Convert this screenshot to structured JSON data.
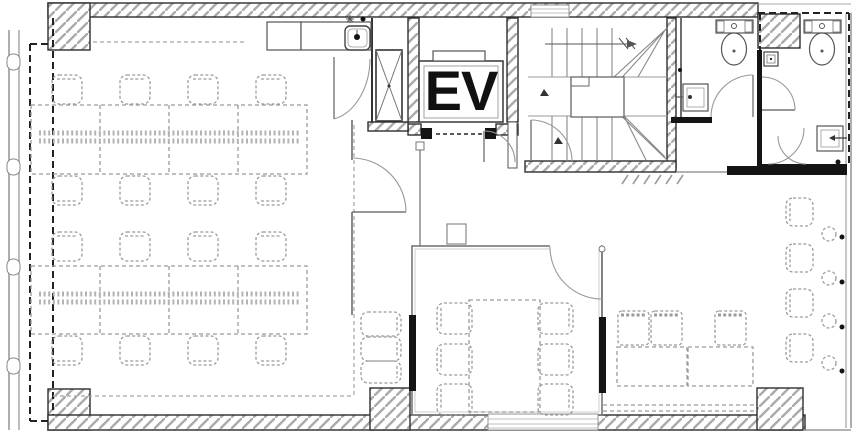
{
  "plan": {
    "elevator_label": "EV",
    "rooms": [
      "office-area",
      "elevator",
      "stairwell",
      "wc-left",
      "wc-right",
      "meeting-room",
      "lounge",
      "hall",
      "kitchenette"
    ],
    "colors": {
      "wall_line": "#2e2e2e",
      "thin_line": "#777777",
      "hatch_line": "#ababab",
      "furniture_line": "#9b9b9b",
      "black_fill": "#141414",
      "glass_line": "#8a8a8a",
      "background": "#ffffff",
      "label_color": "#111111"
    },
    "office_desks": {
      "chair_w": 30,
      "chair_h": 29,
      "clusters": [
        {
          "table": {
            "x": 31,
            "y": 105,
            "w": 276,
            "h": 69
          },
          "dividers": [
            100,
            169,
            238
          ],
          "tray_ys": [
            133,
            141
          ],
          "chairs_top_y": 75,
          "chairs_bottom_y": 176,
          "chair_xs": [
            52,
            120,
            188,
            256
          ]
        },
        {
          "table": {
            "x": 31,
            "y": 266,
            "w": 276,
            "h": 68
          },
          "dividers": [
            100,
            169,
            238
          ],
          "tray_ys": [
            294,
            302
          ],
          "chairs_top_y": 232,
          "chairs_bottom_y": 336,
          "chair_xs": [
            52,
            120,
            188,
            256
          ]
        }
      ]
    },
    "meeting": {
      "table": {
        "x": 469,
        "y": 300,
        "w": 71,
        "h": 112
      },
      "chair_w": 35,
      "chair_h": 31,
      "cols": [
        {
          "x": 437,
          "back": "left"
        },
        {
          "x": 538,
          "back": "right"
        }
      ],
      "rows": [
        303,
        344,
        384
      ]
    },
    "nook_stacked_chairs": [
      {
        "x": 361,
        "y": 312,
        "w": 40,
        "h": 24
      },
      {
        "x": 361,
        "y": 337,
        "w": 40,
        "h": 24
      },
      {
        "x": 361,
        "y": 361,
        "w": 40,
        "h": 22
      }
    ],
    "lounge": {
      "wall_chairs": {
        "x": 786,
        "w": 27,
        "h": 28,
        "rows": [
          198,
          244,
          289,
          334
        ],
        "back": "left"
      },
      "stools": {
        "cx": 829,
        "r": 7,
        "cys": [
          234,
          278,
          321,
          363
        ]
      },
      "wall_dots": {
        "cx": 842,
        "r": 2.5,
        "cys": [
          237,
          282,
          327,
          371
        ]
      },
      "sofas": {
        "y": 311,
        "w": 31,
        "h": 34,
        "xs": [
          618,
          651,
          715
        ]
      },
      "tables": [
        {
          "x": 617,
          "y": 347,
          "w": 70,
          "h": 39
        },
        {
          "x": 688,
          "y": 347,
          "w": 65,
          "h": 39
        }
      ],
      "bottom_band": {
        "x1": 603,
        "x2": 757,
        "ys": [
          405,
          411
        ]
      }
    }
  }
}
